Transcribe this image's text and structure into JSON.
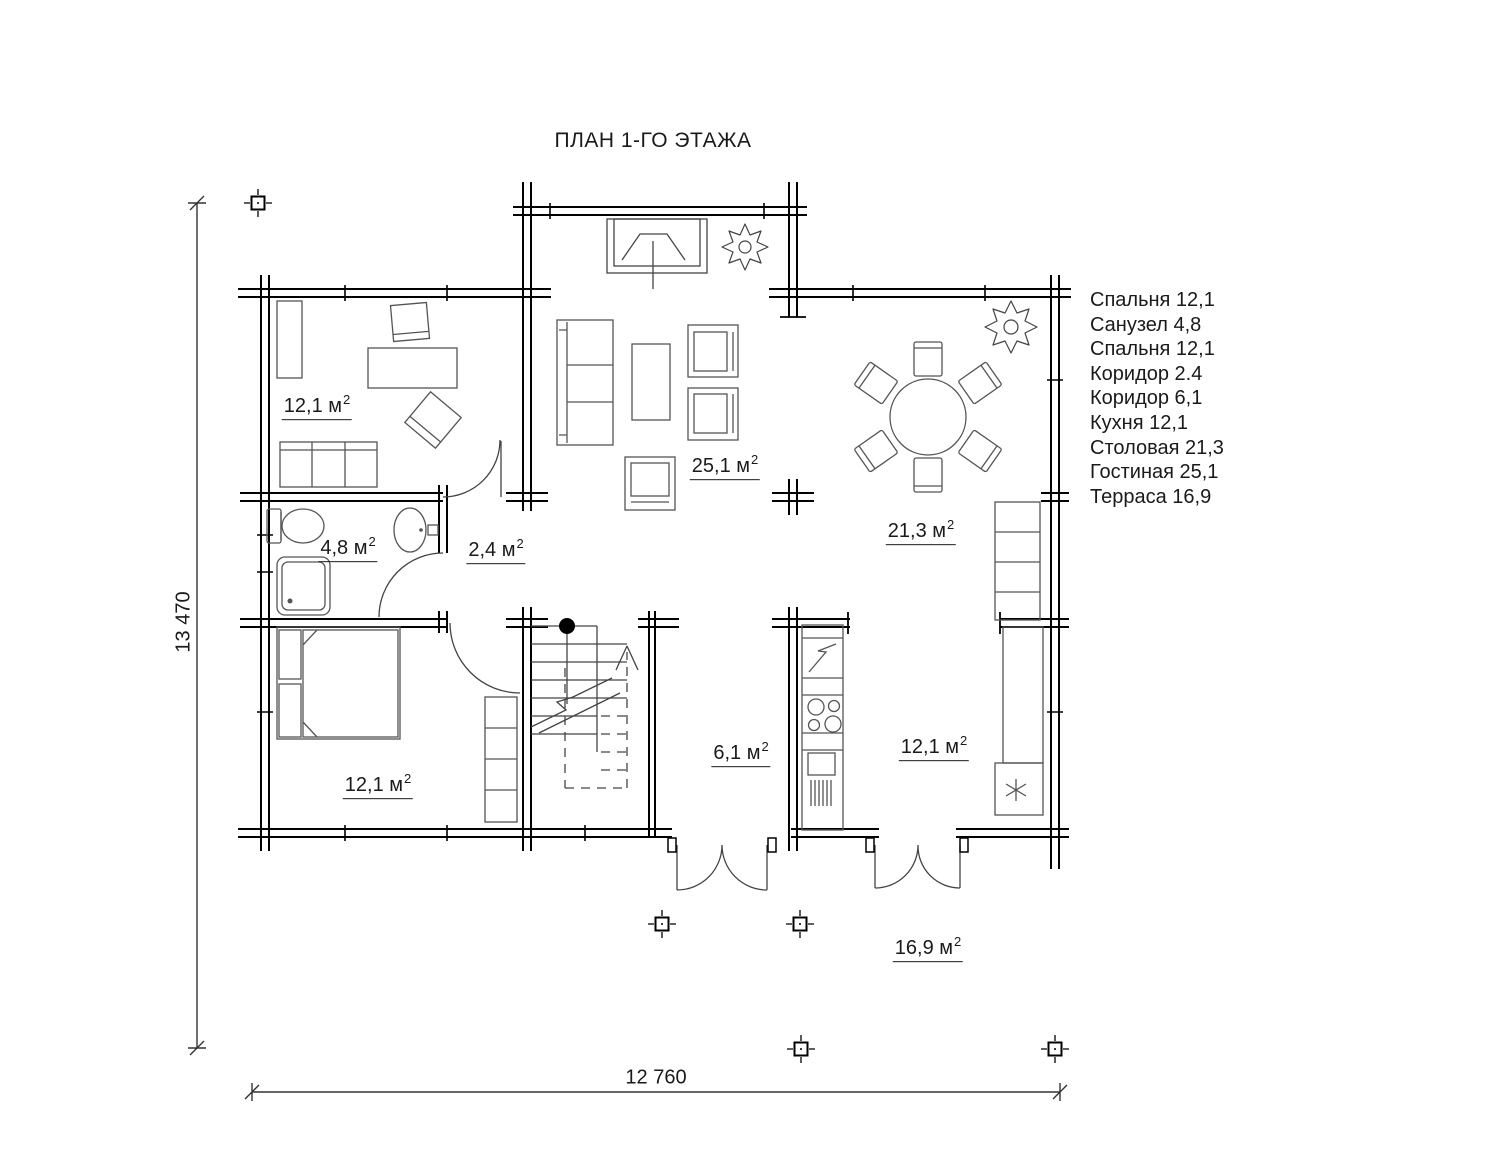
{
  "title": "ПЛАН 1-ГО ЭТАЖА",
  "rooms": {
    "sup": "2",
    "bedroom_top": {
      "area": "12,1 м"
    },
    "bathroom": {
      "area": "4,8 м"
    },
    "corridor_small": {
      "area": "2,4 м"
    },
    "living": {
      "area": "25,1 м"
    },
    "dining": {
      "area": "21,3 м"
    },
    "corridor_hall": {
      "area": "6,1 м"
    },
    "bedroom_bottom": {
      "area": "12,1 м"
    },
    "kitchen": {
      "area": "12,1 м"
    },
    "terrace": {
      "area": "16,9 м"
    }
  },
  "legend": {
    "items": [
      "Спальня 12,1",
      "Санузел 4,8",
      "Спальня 12,1",
      "Коридор 2.4",
      "Коридор 6,1",
      "Кухня 12,1",
      "Столовая 21,3",
      "Гостиная 25,1",
      "Терраса 16,9"
    ]
  },
  "dimensions": {
    "width_label": "12 760",
    "height_label": "13 470"
  },
  "colors": {
    "wall": "#000000",
    "furniture": "#555555",
    "text": "#1a1a1a"
  }
}
